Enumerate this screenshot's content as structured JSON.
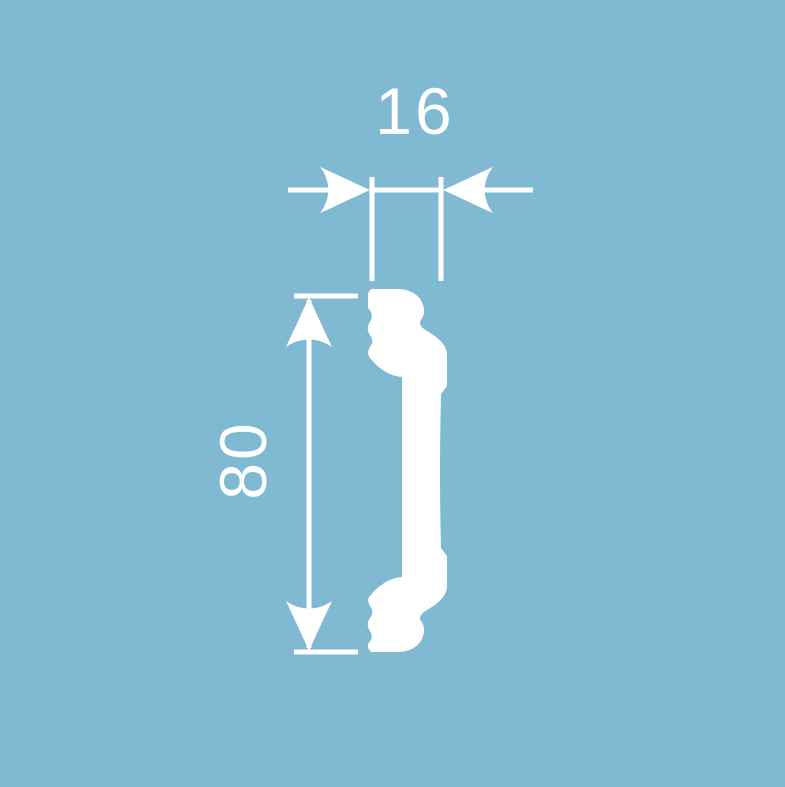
{
  "colors": {
    "background": "#80b9d2",
    "line": "#ffffff"
  },
  "diagram": {
    "width_label": "16",
    "height_label": "80"
  }
}
